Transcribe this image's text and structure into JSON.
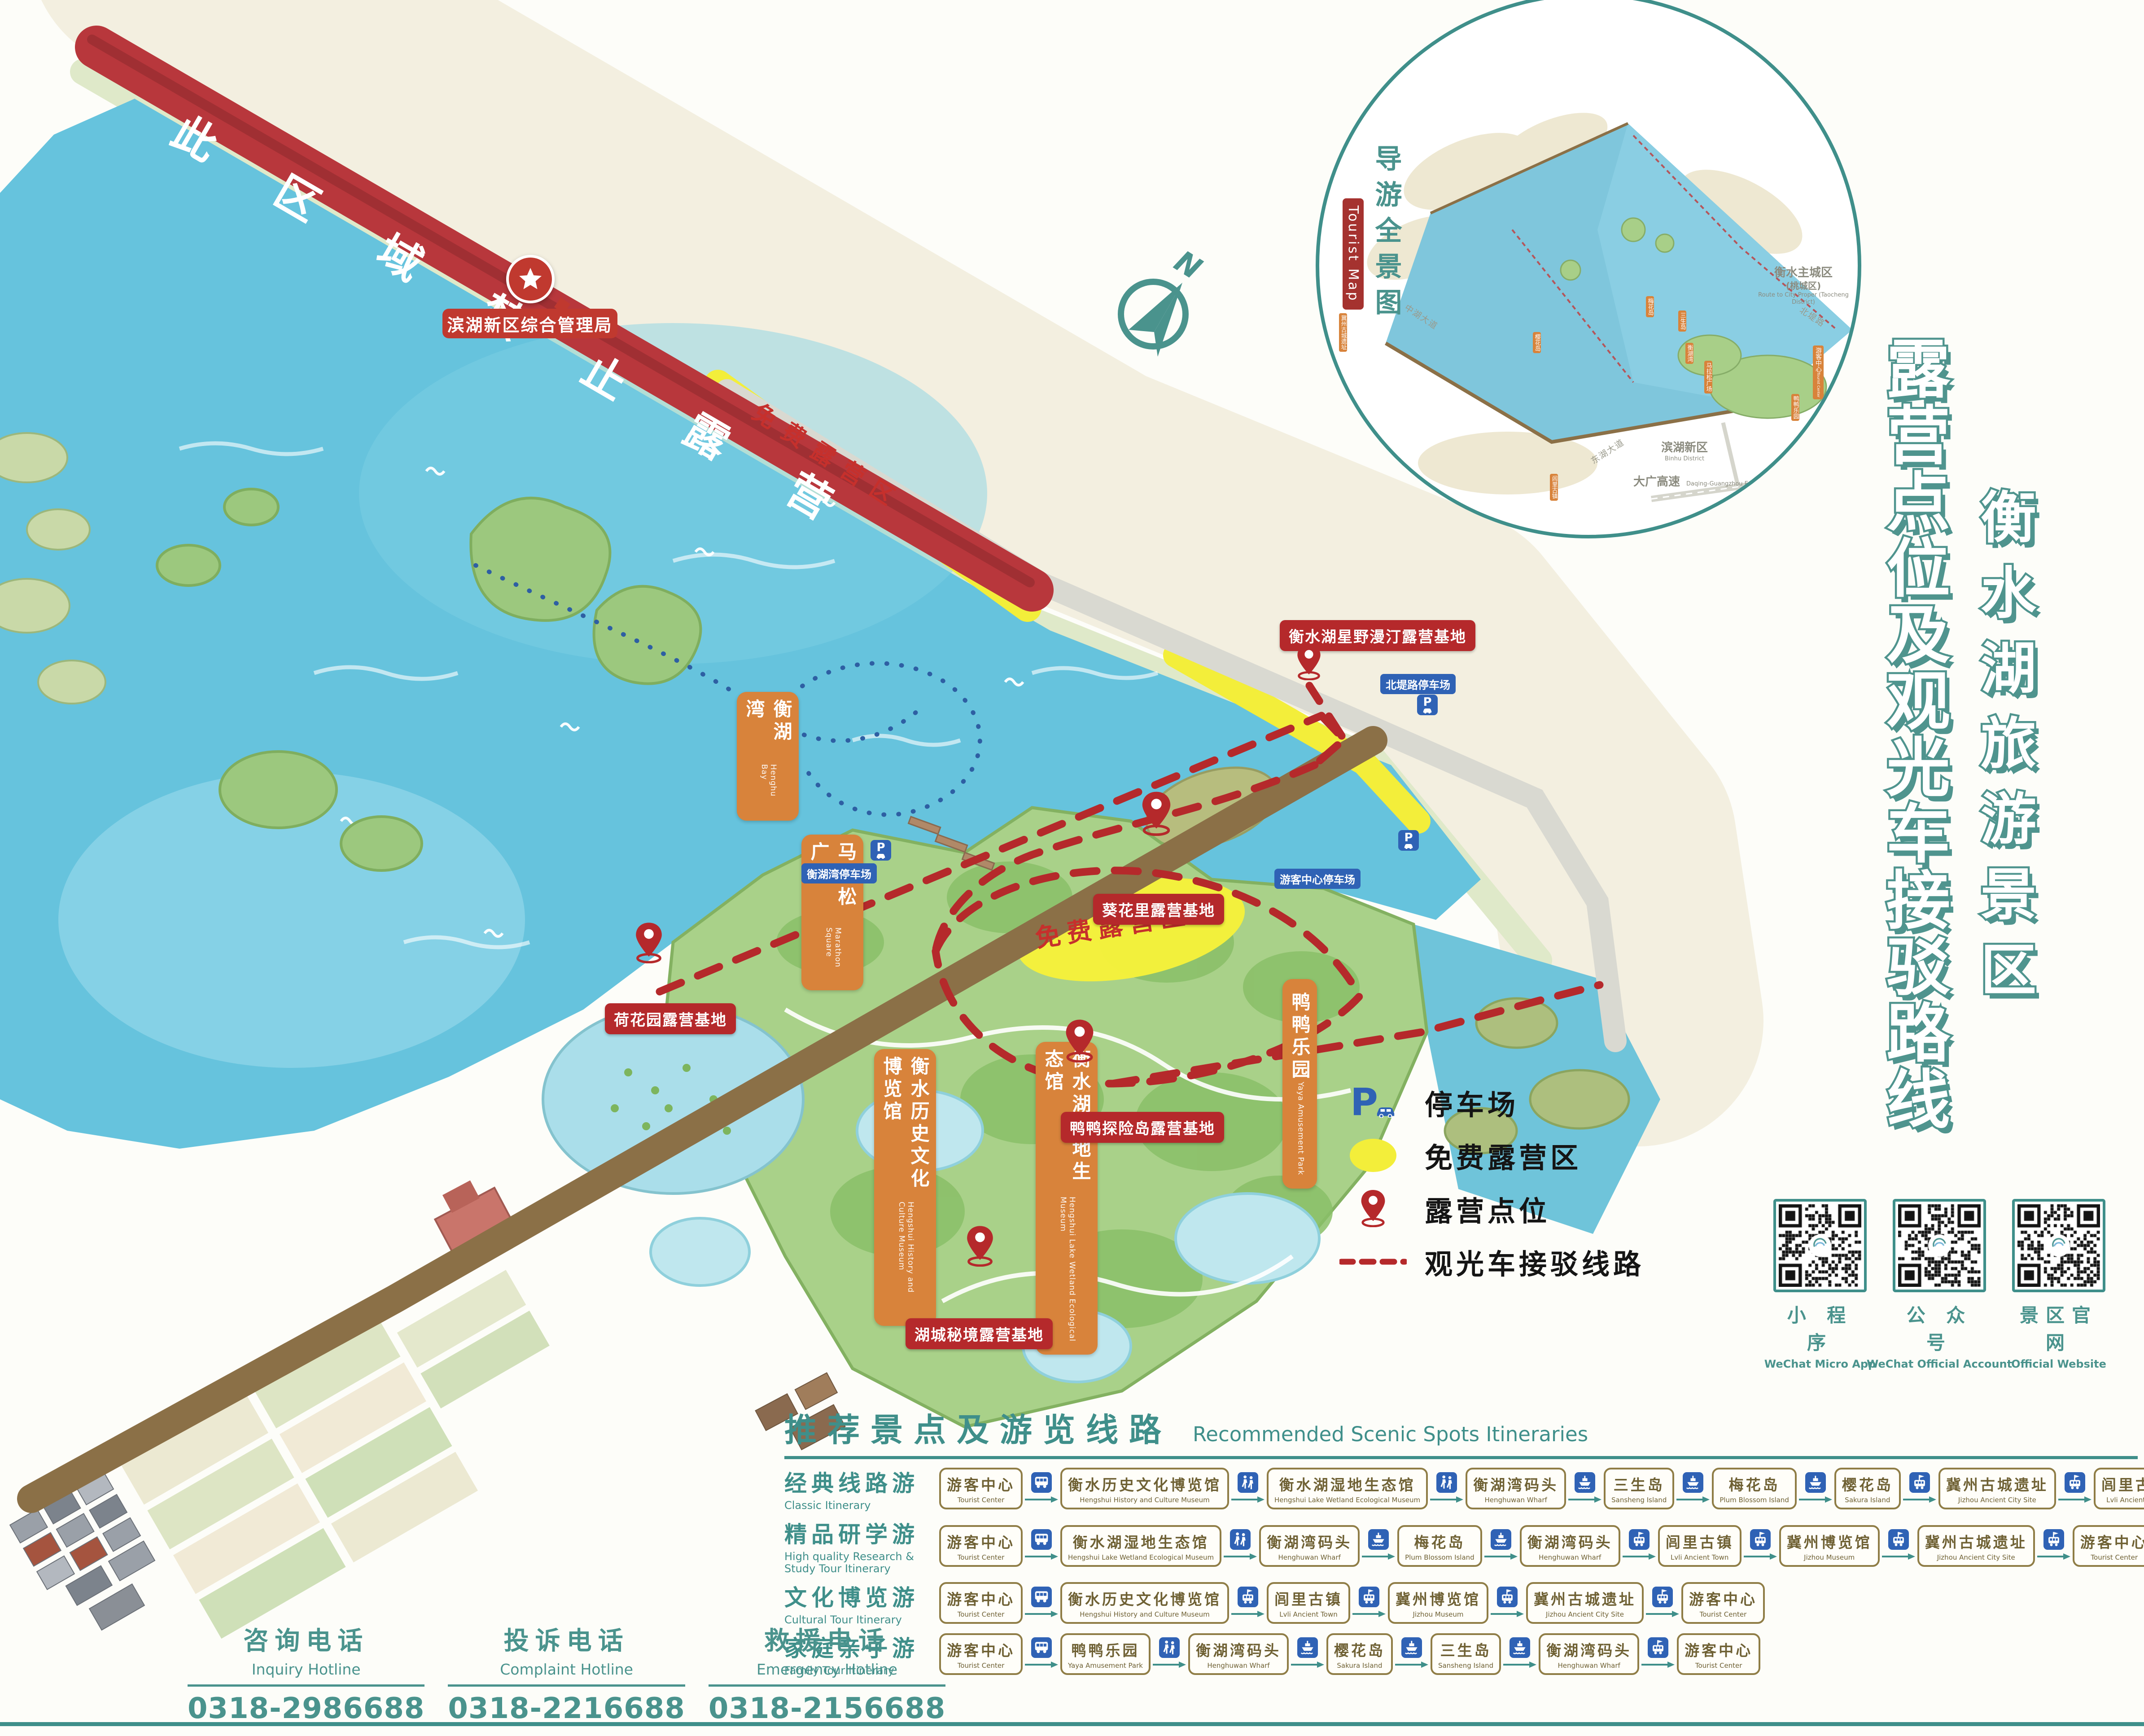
{
  "titles": {
    "main_vertical": "露营点位及观光车接驳路线",
    "site_vertical": "衡水湖旅游景区"
  },
  "map": {
    "banner_text": "此区域禁止露营",
    "banner_label": "滨湖新区综合管理局",
    "free_camp_strip_label": "免费露营区",
    "free_camp_area_label": "免费露营区",
    "compass_n": "N",
    "poi_orange": [
      {
        "zh": "衡湖湾",
        "en": "Henghu Bay"
      },
      {
        "zh": "马拉松广场",
        "en": "Marathon Square"
      },
      {
        "zh": "衡水历史文化博览馆",
        "en": "Hengshui History and Culture Museum"
      },
      {
        "zh": "衡水湖湿地生态馆",
        "en": "Hengshui Lake Wetland Ecological Museum"
      },
      {
        "zh": "鸭鸭乐园",
        "en": "Yaya Amusement Park"
      }
    ],
    "camp_labels": [
      "衡水湖星野漫汀露营基地",
      "葵花里露营基地",
      "鸭鸭探险岛露营基地",
      "湖城秘境露营基地",
      "荷花园露营基地"
    ],
    "parking_labels": [
      "北堤路停车场",
      "游客中心停车场",
      "衡湖湾停车场"
    ]
  },
  "inset": {
    "title_vertical": "导游全景图",
    "tag": "Tourist Map",
    "area_labels": [
      {
        "zh": "衡水主城区",
        "sub": "(桃城区)",
        "en": "Route to City Proper (Taocheng District)"
      },
      {
        "zh": "滨湖新区",
        "sub": "",
        "en": "Binhu District"
      },
      {
        "zh": "大广高速",
        "sub": "",
        "en": "Daqing-Guangzhou Expressway"
      }
    ],
    "road_labels": [
      "北堤路",
      "东湖大道",
      "中湖大道"
    ],
    "poi_tags": [
      "梅花岛",
      "三生岛",
      "樱花岛",
      "衡湖湾",
      "马拉松广场",
      "鸭鸭乐园",
      "冀州古城遗址",
      "冀州博览馆",
      "闾里古镇"
    ],
    "tourist_center_tag": {
      "zh": "游客中心",
      "en": "Tourist Center"
    }
  },
  "legend": {
    "items": [
      {
        "icon": "parking",
        "label": "停车场"
      },
      {
        "icon": "free-camp",
        "label": "免费露营区"
      },
      {
        "icon": "camp-pin",
        "label": "露营点位"
      },
      {
        "icon": "shuttle-route",
        "label": "观光车接驳线路"
      }
    ]
  },
  "qr": [
    {
      "zh": "小 程 序",
      "en": "WeChat Micro App"
    },
    {
      "zh": "公 众 号",
      "en": "WeChat Official Account"
    },
    {
      "zh": "景区官网",
      "en": "Official Website"
    }
  ],
  "itinerary": {
    "title_zh": "推荐景点及游览线路",
    "title_en": "Recommended Scenic Spots Itineraries",
    "rows": [
      {
        "zh": "经典线路游",
        "en": "Classic Itinerary",
        "stops": [
          {
            "zh": "游客中心",
            "en": "Tourist Center"
          },
          {
            "zh": "衡水历史文化博览馆",
            "en": "Hengshui History and Culture Museum"
          },
          {
            "zh": "衡水湖湿地生态馆",
            "en": "Hengshui Lake Wetland Ecological Museum"
          },
          {
            "zh": "衡湖湾码头",
            "en": "Henghuwan Wharf"
          },
          {
            "zh": "三生岛",
            "en": "Sansheng Island"
          },
          {
            "zh": "梅花岛",
            "en": "Plum Blossom Island"
          },
          {
            "zh": "樱花岛",
            "en": "Sakura Island"
          },
          {
            "zh": "冀州古城遗址",
            "en": "Jizhou Ancient City Site"
          },
          {
            "zh": "闾里古镇",
            "en": "Lvli Ancient Town"
          },
          {
            "zh": "游客中心",
            "en": "Tourist Center"
          }
        ],
        "links": [
          "bus",
          "walk",
          "walk",
          "boat",
          "boat",
          "boat",
          "tram",
          "tram",
          "tram"
        ]
      },
      {
        "zh": "精品研学游",
        "en": "High quality Research & Study Tour Itinerary",
        "stops": [
          {
            "zh": "游客中心",
            "en": "Tourist Center"
          },
          {
            "zh": "衡水湖湿地生态馆",
            "en": "Hengshui Lake Wetland Ecological Museum"
          },
          {
            "zh": "衡湖湾码头",
            "en": "Henghuwan Wharf"
          },
          {
            "zh": "梅花岛",
            "en": "Plum Blossom Island"
          },
          {
            "zh": "衡湖湾码头",
            "en": "Henghuwan Wharf"
          },
          {
            "zh": "闾里古镇",
            "en": "Lvli Ancient Town"
          },
          {
            "zh": "冀州博览馆",
            "en": "Jizhou Museum"
          },
          {
            "zh": "冀州古城遗址",
            "en": "Jizhou Ancient City Site"
          },
          {
            "zh": "游客中心",
            "en": "Tourist Center"
          }
        ],
        "links": [
          "bus",
          "walk",
          "boat",
          "boat",
          "tram",
          "tram",
          "tram",
          "tram"
        ]
      },
      {
        "zh": "文化博览游",
        "en": "Cultural Tour Itinerary",
        "stops": [
          {
            "zh": "游客中心",
            "en": "Tourist Center"
          },
          {
            "zh": "衡水历史文化博览馆",
            "en": "Hengshui History and Culture Museum"
          },
          {
            "zh": "闾里古镇",
            "en": "Lvli Ancient Town"
          },
          {
            "zh": "冀州博览馆",
            "en": "Jizhou Museum"
          },
          {
            "zh": "冀州古城遗址",
            "en": "Jizhou Ancient City Site"
          },
          {
            "zh": "游客中心",
            "en": "Tourist Center"
          }
        ],
        "links": [
          "bus",
          "tram",
          "tram",
          "tram",
          "tram"
        ]
      },
      {
        "zh": "家庭亲子游",
        "en": "Family Tour Itinerary",
        "stops": [
          {
            "zh": "游客中心",
            "en": "Tourist Center"
          },
          {
            "zh": "鸭鸭乐园",
            "en": "Yaya Amusement Park"
          },
          {
            "zh": "衡湖湾码头",
            "en": "Henghuwan Wharf"
          },
          {
            "zh": "樱花岛",
            "en": "Sakura Island"
          },
          {
            "zh": "三生岛",
            "en": "Sansheng Island"
          },
          {
            "zh": "衡湖湾码头",
            "en": "Henghuwan Wharf"
          },
          {
            "zh": "游客中心",
            "en": "Tourist Center"
          }
        ],
        "links": [
          "bus",
          "walk",
          "boat",
          "boat",
          "boat",
          "tram"
        ]
      }
    ]
  },
  "hotlines": [
    {
      "zh": "咨询电话",
      "en": "Inquiry Hotline",
      "number": "0318-2986688"
    },
    {
      "zh": "投诉电话",
      "en": "Complaint Hotline",
      "number": "0318-2216688"
    },
    {
      "zh": "救援电话",
      "en": "Emergency Hotline",
      "number": "0318-2156688"
    }
  ],
  "colors": {
    "teal": "#3f8f8a",
    "banner_red": "#b8373c",
    "camp_red": "#b5292b",
    "poi_orange": "#d8833b",
    "transit_blue": "#2f62b5",
    "camp_yellow": "#f3ee3a",
    "lake_blue": "#66c3dd",
    "road_brown": "#8b7047"
  }
}
